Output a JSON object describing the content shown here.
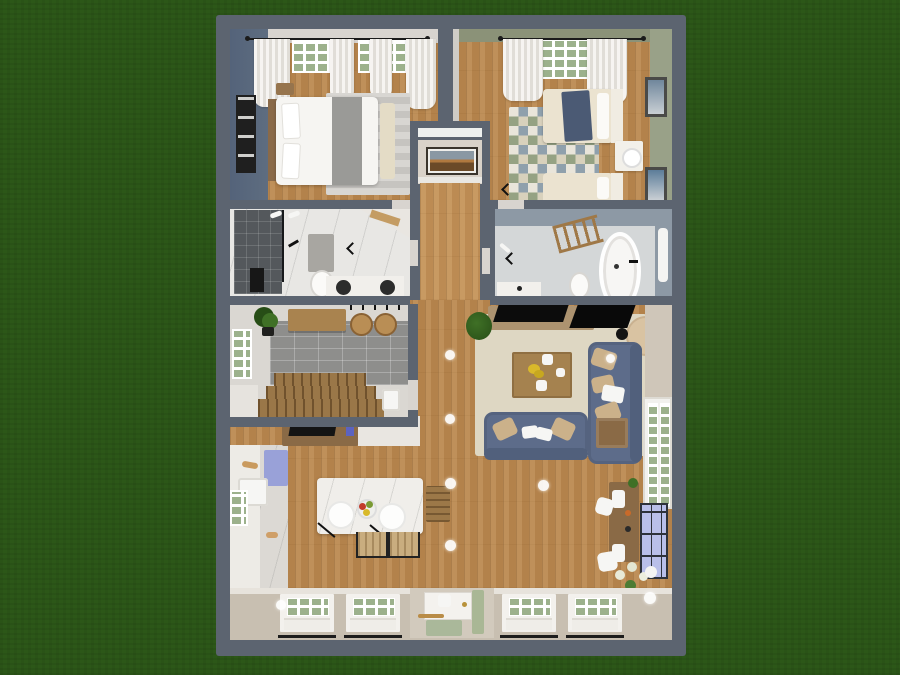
{
  "meta": {
    "scene": "top-down 3d floor plan render of a single-story home on grass",
    "style": "home-design-app render, no visible text or UI chrome"
  },
  "palette": {
    "grass": "#2c5718",
    "outer": "#5c6470",
    "wallLight": "#d8d4cf",
    "wood": "#b8874f",
    "hallwood": "#c29158",
    "accentBlue": "#5e6d80",
    "sage": "#99a188",
    "sageDark": "#8b9278",
    "bathBlue": "#8d99a5",
    "marble": "#e8e7e4",
    "bathFloor": "#d4d7d8",
    "darkTile": "#54585c",
    "grayTile": "#8e8e8c",
    "rugBeige": "#ded7c3",
    "rugGray": "#cbc9c5",
    "sofaBlue": "#5d6c8a",
    "sofaBlueDark": "#51607c",
    "pillowBeige": "#cbb18a",
    "tableWood": "#a5824f",
    "consoleTan": "#ad9370",
    "deskWood": "#8a6a46",
    "cream": "#ebe3d0",
    "blanketBlue": "#4b5a74",
    "pane": "#9cb18c",
    "porchTan": "#c8bfb1",
    "island": "#f0eeea",
    "counter": "#edebe6",
    "marbleCounter": "#dcd9d4",
    "blueCab": "#99a1d8",
    "stoolWood": "#b98e55",
    "chairTan": "#c9ad7f",
    "stairWood": "#9a7748",
    "plantGreen": "#3f7026",
    "plantDark": "#274d16",
    "lavWindow": "#b9bfe9",
    "gold": "#b8923a",
    "flowerYellow": "#d9b92a",
    "fruitRed": "#c23b2a",
    "fruitGreen": "#7a9a33",
    "benchCream": "#e4dcc6",
    "throwGray": "#9a9a97"
  },
  "rooms": [
    {
      "id": "bedroom-left",
      "label": "bedroom with double bed",
      "items": [
        "curtain rod",
        "two windows",
        "white curtains",
        "blue-gray accent wall",
        "four-pane wall art",
        "double bed",
        "wood headboard",
        "pillows",
        "gray throw",
        "striped gray rug",
        "cream bench",
        "nightstand",
        "door swing"
      ]
    },
    {
      "id": "bedroom-right",
      "label": "bedroom with twin beds",
      "items": [
        "curtain rod",
        "window",
        "white curtains",
        "sage walls",
        "two framed artworks",
        "twin bed with blue blanket",
        "twin bed",
        "nightstand with lamp",
        "triangle pattern rug",
        "door swing"
      ]
    },
    {
      "id": "hallway",
      "label": "stair hallway",
      "items": [
        "landscape artwork",
        "wood runner floor"
      ]
    },
    {
      "id": "bathroom-left",
      "label": "shower bathroom",
      "items": [
        "dark tile walk-in shower",
        "glass partition",
        "black bath mat",
        "gray mat",
        "toilet",
        "double vanity",
        "two dark round sinks",
        "towels",
        "corner shelf"
      ]
    },
    {
      "id": "bathroom-right",
      "label": "main bathroom",
      "items": [
        "ladder towel rack",
        "freestanding bathtub",
        "black faucet",
        "toilet",
        "vanity sink",
        "wall mirror",
        "blue-gray walls"
      ]
    },
    {
      "id": "mudroom",
      "label": "mudroom with staircase",
      "items": [
        "wood bench",
        "potted plant",
        "two round stools",
        "coat hooks",
        "gray tile floor",
        "staircase",
        "window",
        "utility sink"
      ]
    },
    {
      "id": "living-room",
      "label": "living room",
      "items": [
        "media console",
        "flat tv",
        "round pouf",
        "black vase",
        "blue loveseat",
        "blue sofa",
        "beige pillows",
        "coffee table with yellow flowers",
        "beige area rug",
        "side table",
        "potted plant",
        "french doors with green panes"
      ]
    },
    {
      "id": "kitchen-dining",
      "label": "kitchen and dining",
      "items": [
        "wall counters",
        "marble worktop",
        "blue cabinet",
        "kitchen sink",
        "side window",
        "marble island",
        "two pendant lamps",
        "fruit bowl",
        "two woven chairs",
        "wood chair",
        "tv stand with monitor"
      ]
    },
    {
      "id": "office-corner",
      "label": "desk corner",
      "items": [
        "wood desk",
        "papers",
        "two white chairs",
        "lavender grid window",
        "flower plant"
      ]
    },
    {
      "id": "entry-porch",
      "label": "front wall and porch",
      "items": [
        "four green-pane windows with flower rails",
        "front door",
        "gold handle",
        "green door mat",
        "green runner",
        "white stool",
        "ceiling light globes"
      ]
    }
  ]
}
